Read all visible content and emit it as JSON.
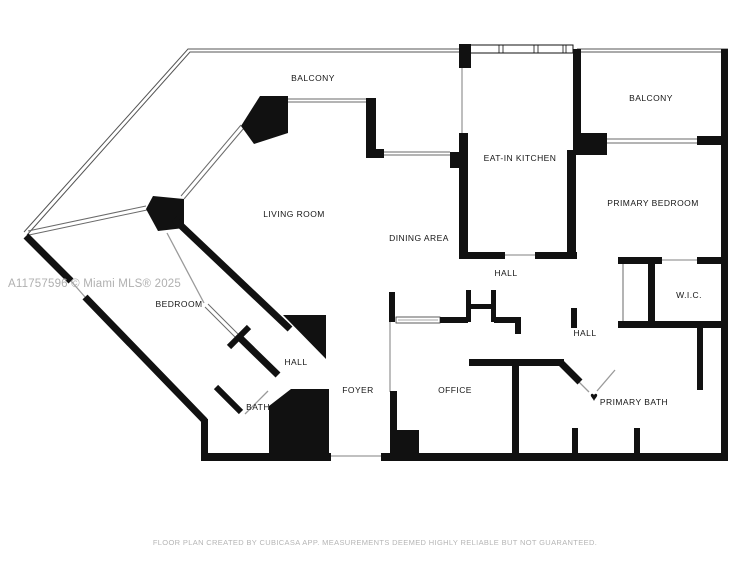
{
  "watermark": "A11757596 © Miami MLS® 2025",
  "disclaimer": "FLOOR PLAN CREATED BY CUBICASA APP. MEASUREMENTS DEEMED HIGHLY RELIABLE BUT NOT GUARANTEED.",
  "floorplan": {
    "rooms": [
      {
        "label": "BALCONY",
        "x": 313,
        "y": 78
      },
      {
        "label": "EAT-IN KITCHEN",
        "x": 520,
        "y": 158
      },
      {
        "label": "BALCONY",
        "x": 651,
        "y": 98
      },
      {
        "label": "PRIMARY BEDROOM",
        "x": 653,
        "y": 203
      },
      {
        "label": "LIVING ROOM",
        "x": 294,
        "y": 214
      },
      {
        "label": "DINING AREA",
        "x": 419,
        "y": 238
      },
      {
        "label": "HALL",
        "x": 506,
        "y": 273
      },
      {
        "label": "W.I.C.",
        "x": 689,
        "y": 295
      },
      {
        "label": "BEDROOM",
        "x": 179,
        "y": 304
      },
      {
        "label": "HALL",
        "x": 585,
        "y": 333
      },
      {
        "label": "HALL",
        "x": 296,
        "y": 362
      },
      {
        "label": "FOYER",
        "x": 358,
        "y": 390
      },
      {
        "label": "OFFICE",
        "x": 455,
        "y": 390
      },
      {
        "label": "BATH",
        "x": 258,
        "y": 407
      },
      {
        "label": "PRIMARY BATH",
        "x": 634,
        "y": 402
      }
    ],
    "door_marker": {
      "symbol": "♥",
      "x": 594,
      "y": 397
    }
  },
  "colors": {
    "wall": "#111111",
    "opening": "#9a9a9a",
    "railing": "#555555",
    "watermark": "#b0b0b0",
    "disclaimer": "#b5b5b5",
    "background": "#ffffff"
  }
}
